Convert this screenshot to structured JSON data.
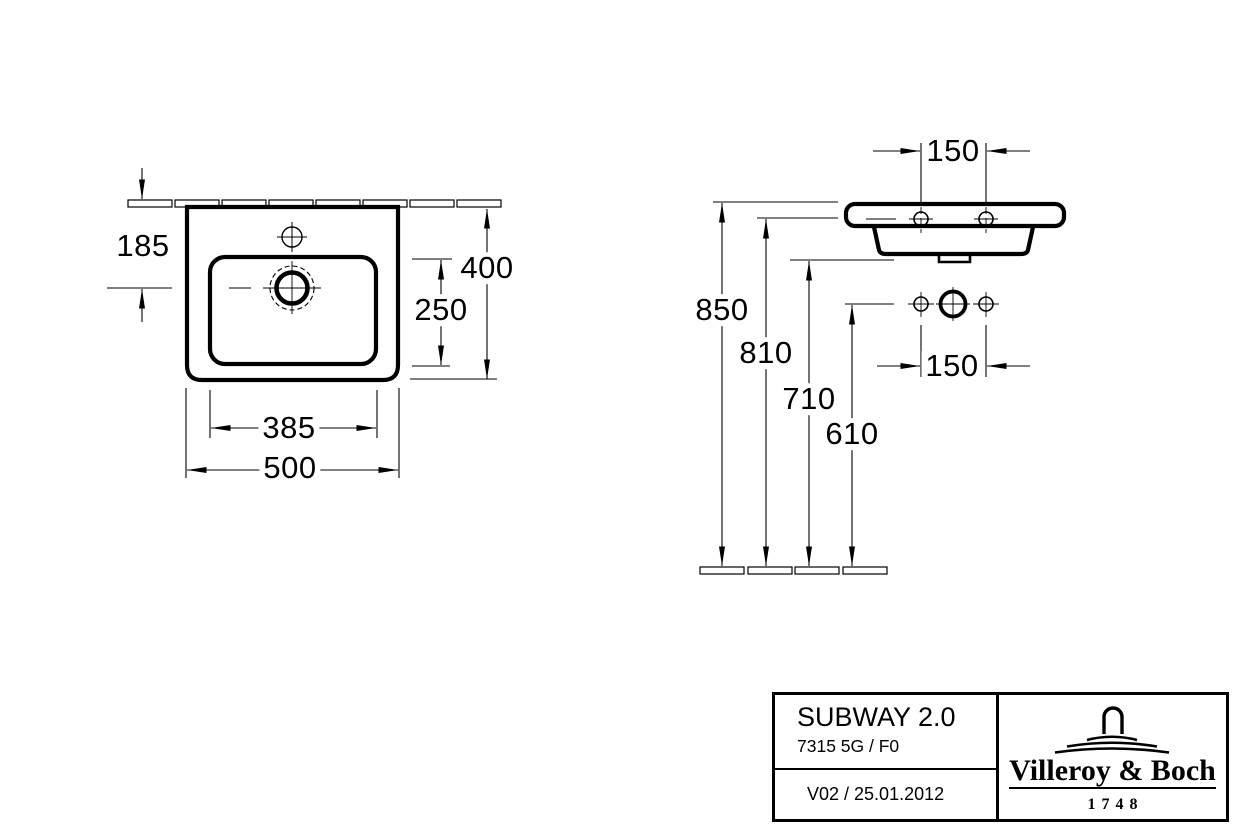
{
  "plan_view": {
    "dim_tap_setback": "185",
    "dim_depth": "400",
    "dim_bowl_depth": "250",
    "dim_bowl_width": "385",
    "dim_overall_width": "500"
  },
  "front_view": {
    "dim_hole_spacing_top": "150",
    "dim_hole_spacing_mid": "150",
    "dim_height_rim": "850",
    "dim_height_rim_underside": "810",
    "dim_height_outlet": "710",
    "dim_height_fixing": "610"
  },
  "title_block": {
    "series": "SUBWAY 2.0",
    "model": "7315 5G / F0",
    "revision": "V02 / 25.01.2012",
    "brand": "Villeroy & Boch",
    "brand_since": "1748"
  },
  "colors": {
    "line": "#000000",
    "background": "#ffffff"
  }
}
